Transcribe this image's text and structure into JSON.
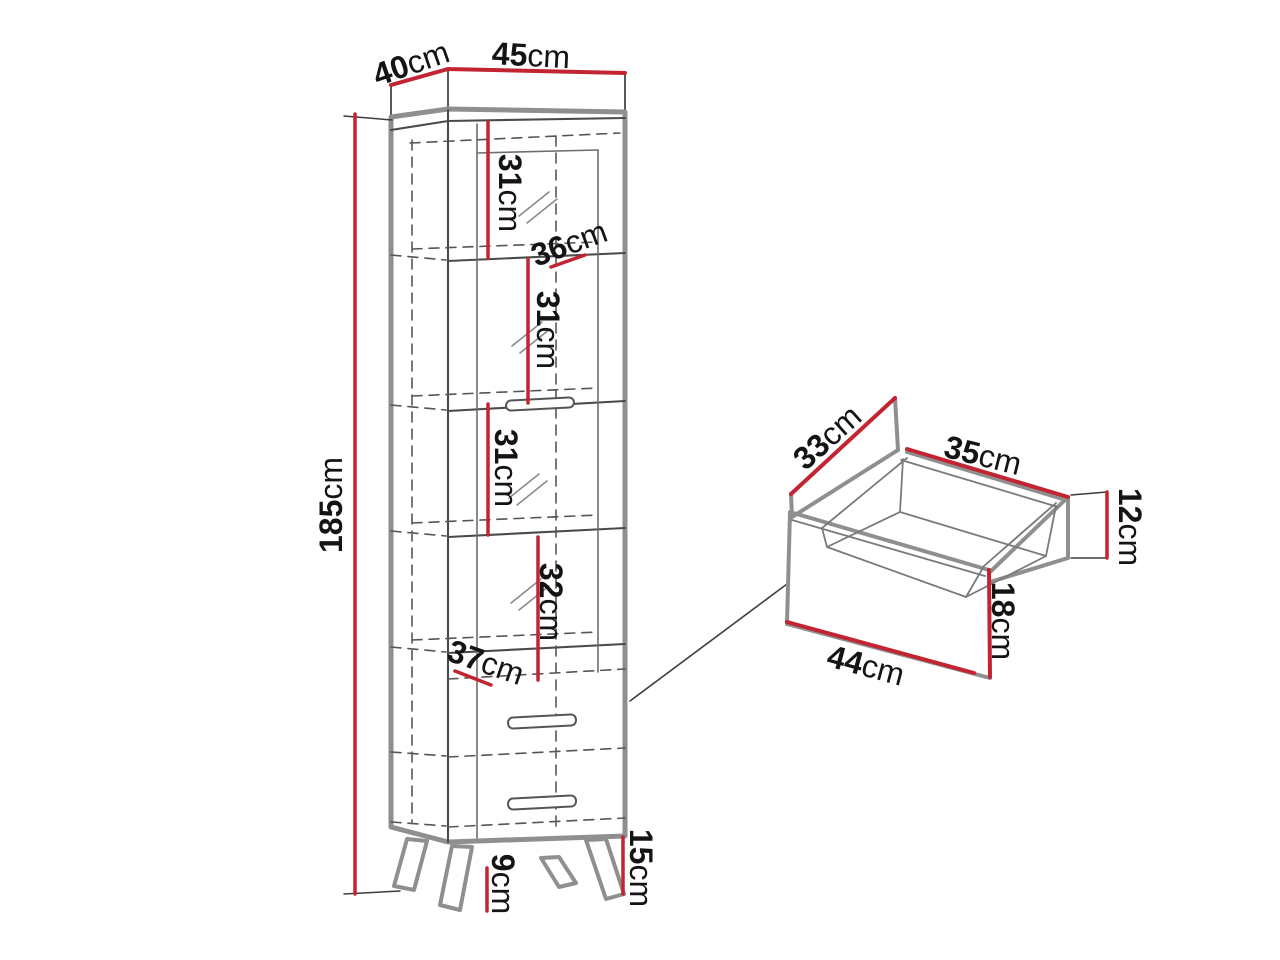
{
  "document": {
    "type": "furniture-dimension-diagram",
    "background": "#ffffff"
  },
  "colors": {
    "dimension_line_red": "#c22531",
    "panel_outline_gray": "#8f8f8f",
    "sketch_line_dark": "#4a4a4a",
    "label_text": "#141414"
  },
  "cabinet": {
    "dims": {
      "d40": {
        "value": "40",
        "unit": "cm"
      },
      "d45": {
        "value": "45",
        "unit": "cm"
      },
      "d31a": {
        "value": "31",
        "unit": "cm"
      },
      "d36": {
        "value": "36",
        "unit": "cm"
      },
      "d31b": {
        "value": "31",
        "unit": "cm"
      },
      "d31c": {
        "value": "31",
        "unit": "cm"
      },
      "d32": {
        "value": "32",
        "unit": "cm"
      },
      "d37": {
        "value": "37",
        "unit": "cm"
      },
      "d185": {
        "value": "185",
        "unit": "cm"
      },
      "d15": {
        "value": "15",
        "unit": "cm"
      },
      "d9": {
        "value": "9",
        "unit": "cm"
      }
    }
  },
  "drawer": {
    "dims": {
      "d33": {
        "value": "33",
        "unit": "cm"
      },
      "d35": {
        "value": "35",
        "unit": "cm"
      },
      "d12": {
        "value": "12",
        "unit": "cm"
      },
      "d18": {
        "value": "18",
        "unit": "cm"
      },
      "d44": {
        "value": "44",
        "unit": "cm"
      }
    }
  }
}
